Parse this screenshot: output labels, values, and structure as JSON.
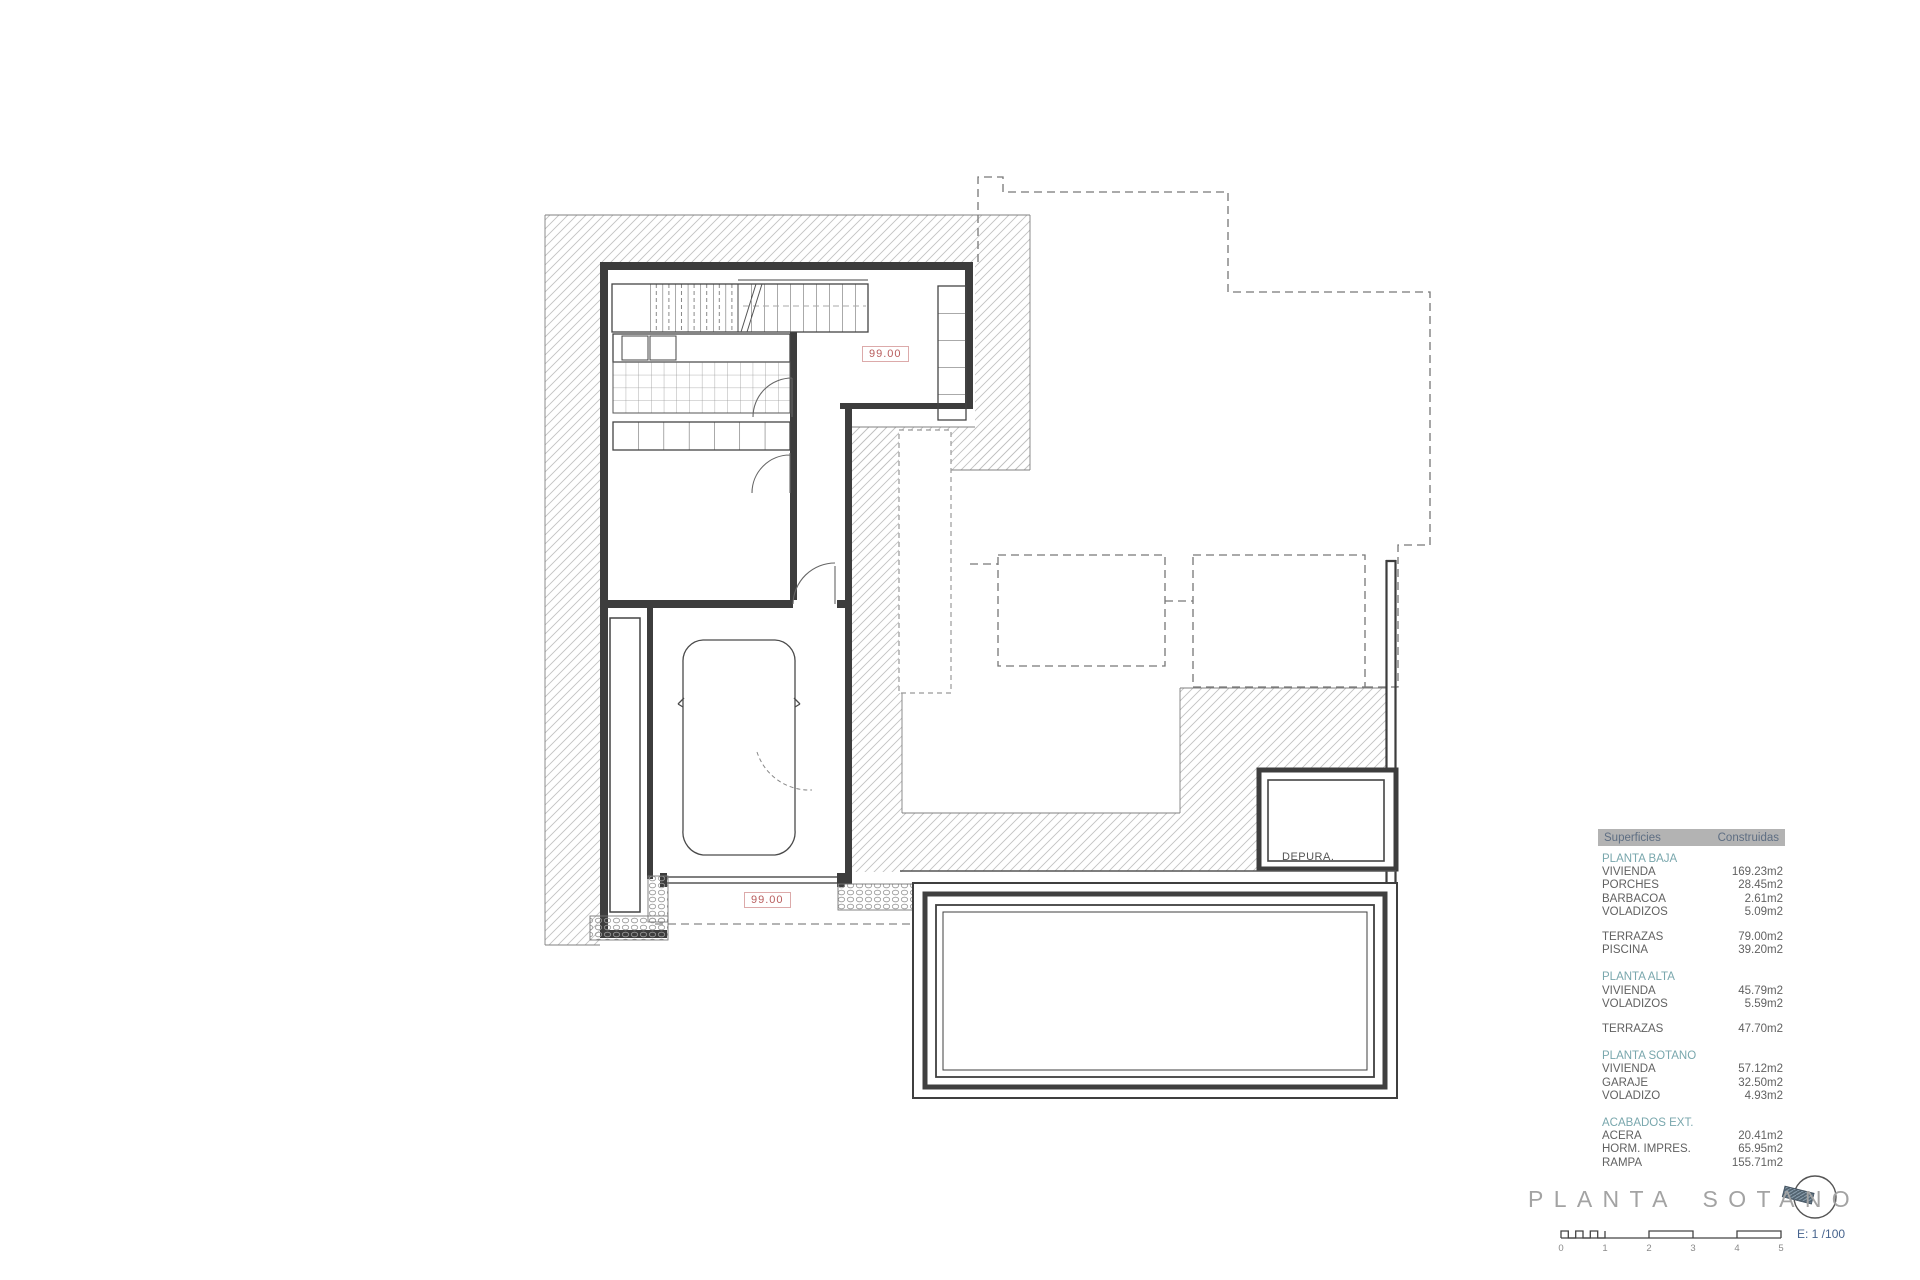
{
  "drawing": {
    "labels": {
      "upper_level": "99.00",
      "lower_level": "99.00",
      "plant_room": "DEPURA."
    }
  },
  "legend": {
    "header": {
      "col1": "Superficies",
      "col2": "Construidas"
    },
    "rows": [
      {
        "type": "section",
        "label": "PLANTA BAJA"
      },
      {
        "type": "item",
        "label": "VIVIENDA",
        "value": "169.23m2"
      },
      {
        "type": "item",
        "label": "PORCHES",
        "value": "28.45m2"
      },
      {
        "type": "item",
        "label": "BARBACOA",
        "value": "2.61m2"
      },
      {
        "type": "item",
        "label": "VOLADIZOS",
        "value": "5.09m2"
      },
      {
        "type": "gap"
      },
      {
        "type": "item",
        "label": "TERRAZAS",
        "value": "79.00m2"
      },
      {
        "type": "item",
        "label": "PISCINA",
        "value": "39.20m2"
      },
      {
        "type": "gap"
      },
      {
        "type": "section",
        "label": "PLANTA ALTA"
      },
      {
        "type": "item",
        "label": "VIVIENDA",
        "value": "45.79m2"
      },
      {
        "type": "item",
        "label": "VOLADIZOS",
        "value": "5.59m2"
      },
      {
        "type": "gap"
      },
      {
        "type": "item",
        "label": "TERRAZAS",
        "value": "47.70m2"
      },
      {
        "type": "gap"
      },
      {
        "type": "section",
        "label": "PLANTA SOTANO"
      },
      {
        "type": "item",
        "label": "VIVIENDA",
        "value": "57.12m2"
      },
      {
        "type": "item",
        "label": "GARAJE",
        "value": "32.50m2"
      },
      {
        "type": "item",
        "label": "VOLADIZO",
        "value": "4.93m2"
      },
      {
        "type": "gap"
      },
      {
        "type": "section",
        "label": "ACABADOS EXT."
      },
      {
        "type": "item",
        "label": "ACERA",
        "value": "20.41m2"
      },
      {
        "type": "item",
        "label": "HORM. IMPRES.",
        "value": "65.95m2"
      },
      {
        "type": "item",
        "label": "RAMPA",
        "value": "155.71m2"
      }
    ]
  },
  "footer": {
    "title": "PLANTA SOTANO",
    "scale_note": "E: 1 /100",
    "scale_ticks": [
      "0",
      "1",
      "2",
      "3",
      "4",
      "5"
    ]
  },
  "colors": {
    "wall": "#3d3d3d",
    "hatch": "#c2c2c2",
    "marker_text": "#b85c5c",
    "marker_border": "#dcaaaa",
    "section_teal": "#79a7ad",
    "header_bg": "#b3b3b3",
    "scale_blue": "#47648e",
    "title_gray": "#a3a3a3"
  }
}
